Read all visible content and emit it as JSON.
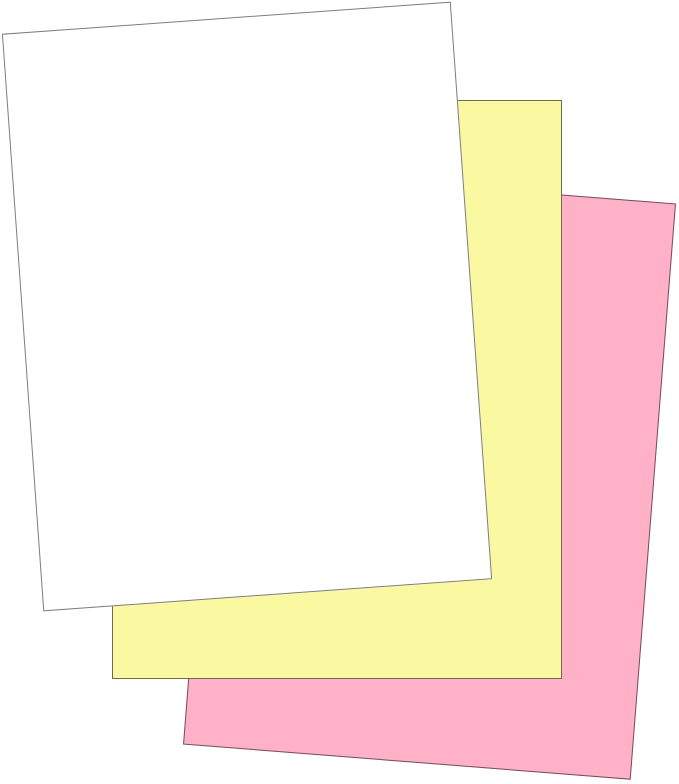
{
  "image": {
    "description": "Three overlapping blank sheets of carbonless copy paper fanned out on a white background",
    "background_color": "#ffffff",
    "sheets": [
      {
        "name": "pink-sheet",
        "label": "Pink sheet (back)",
        "fill": "#ffb1c8",
        "border": "#774c59",
        "stack_position": "back"
      },
      {
        "name": "canary-sheet",
        "label": "Canary yellow sheet (middle)",
        "fill": "#faf8a1",
        "border": "#6f6b48",
        "stack_position": "middle"
      },
      {
        "name": "white-sheet",
        "label": "White sheet (front)",
        "fill": "#ffffff",
        "border": "#7d7d7d",
        "stack_position": "front"
      }
    ]
  }
}
